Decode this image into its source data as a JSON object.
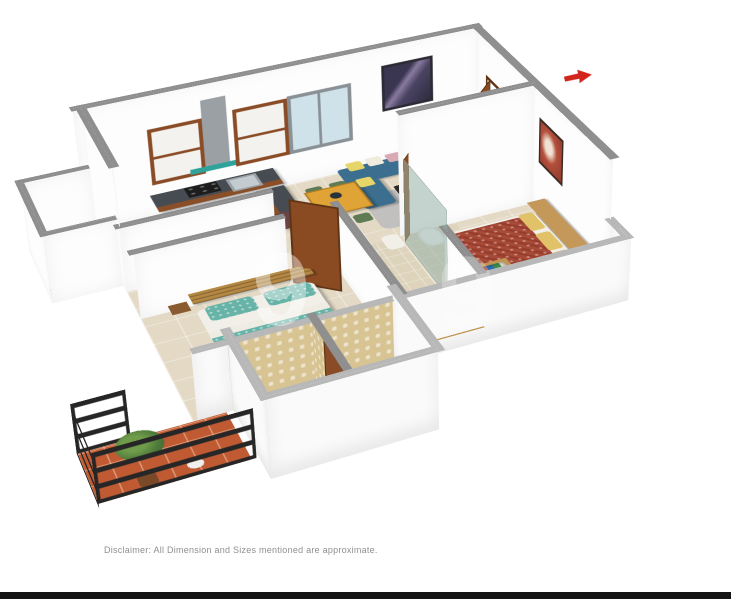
{
  "image": {
    "type": "3d-isometric-floor-plan-render",
    "background": "#ffffff"
  },
  "annotations": {
    "disclaimer": "Disclaimer: All Dimension and Sizes mentioned are approximate.",
    "watermark_glyph": "9",
    "watermark_glyph_2": "9"
  },
  "compass": {
    "color": "#d2261c",
    "direction": "right"
  },
  "footer_bar_color": "#141414",
  "floor_plan": {
    "rooms": [
      "living-room",
      "kitchen",
      "utility-wash-area",
      "bedroom-2",
      "common-bathroom",
      "corridor",
      "master-bedroom",
      "master-bathroom",
      "balcony",
      "attached-bathroom-block"
    ],
    "palette": {
      "floor_tile": "#e3d9c5",
      "wall_white": "#fdfdfd",
      "wall_cap_gray": "#8f8f8f",
      "sofa_teal": "#3c6f8f",
      "cushion_yellow": "#e6d669",
      "cushion_pink": "#d9a9b4",
      "dining_table_yellow": "#e0a335",
      "chair_green": "#5e7b54",
      "kitchen_counter": "#474c52",
      "cabinet_brown": "#8a4c26",
      "fridge_maroon": "#6b4344",
      "bed2_teal": "#68b3a8",
      "master_bed_red": "#a84a38",
      "pillow_yellow": "#e2c268",
      "headboard_tan": "#c49858",
      "balcony_tile": "#c05a32",
      "railing_black": "#262626",
      "bathroom_mosaic": "#d8c492",
      "door_brown": "#8a4a22",
      "glass_partition": "#9fb5ae",
      "window_glass": "#cfe2ea"
    }
  }
}
